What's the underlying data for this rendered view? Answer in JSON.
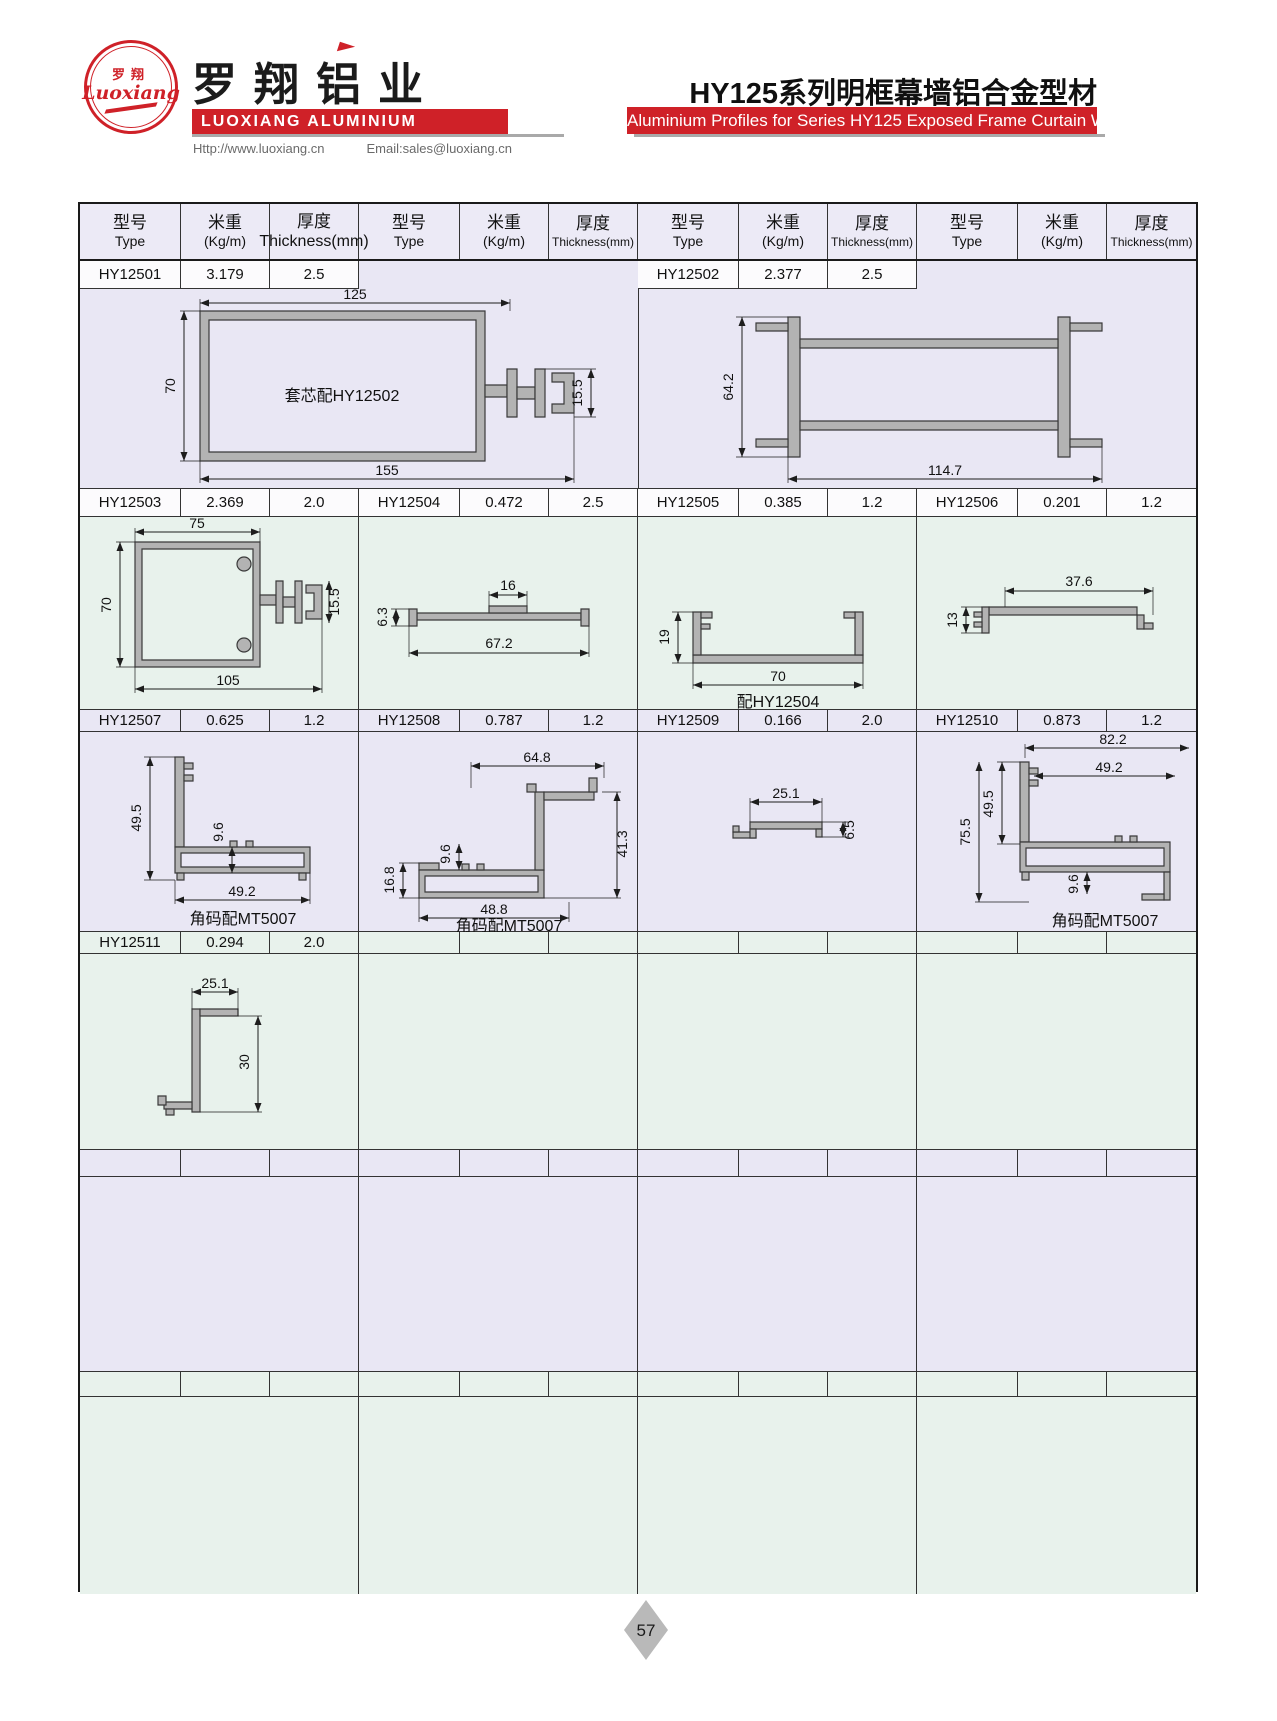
{
  "brand": {
    "logo_zh": "罗翔",
    "logo_script": "Luoxiang",
    "name_zh": "罗翔铝业",
    "name_en": "LUOXIANG ALUMINIUM",
    "website": "Http://www.luoxiang.cn",
    "email": "Email:sales@luoxiang.cn"
  },
  "title": {
    "zh": "HY125系列明框幕墙铝合金型材",
    "en": "Aluminium Profiles for Series HY125 Exposed Frame Curtain Wall"
  },
  "header": {
    "type_zh": "型号",
    "type_en": "Type",
    "weight_zh": "米重",
    "weight_en": "(Kg/m)",
    "thick_zh": "厚度",
    "thick_en": "Thickness(mm)"
  },
  "profiles": {
    "hy12501": {
      "type": "HY12501",
      "weight": "3.179",
      "thickness": "2.5",
      "note": "套芯配HY12502",
      "dim_top": "125",
      "dim_left": "70",
      "dim_bottom": "155",
      "dim_right": "15.5"
    },
    "hy12502": {
      "type": "HY12502",
      "weight": "2.377",
      "thickness": "2.5",
      "dim_left": "64.2",
      "dim_bottom": "114.7"
    },
    "hy12503": {
      "type": "HY12503",
      "weight": "2.369",
      "thickness": "2.0",
      "dim_top": "75",
      "dim_left": "70",
      "dim_right": "15.5",
      "dim_bottom": "105"
    },
    "hy12504": {
      "type": "HY12504",
      "weight": "0.472",
      "thickness": "2.5",
      "dim_left": "6.3",
      "dim_top": "16",
      "dim_bottom": "67.2"
    },
    "hy12505": {
      "type": "HY12505",
      "weight": "0.385",
      "thickness": "1.2",
      "note": "配HY12504",
      "dim_left": "19",
      "dim_bottom": "70"
    },
    "hy12506": {
      "type": "HY12506",
      "weight": "0.201",
      "thickness": "1.2",
      "dim_top": "37.6",
      "dim_left": "13"
    },
    "hy12507": {
      "type": "HY12507",
      "weight": "0.625",
      "thickness": "1.2",
      "note": "角码配MT5007",
      "dim_left": "49.5",
      "dim_mid": "9.6",
      "dim_bottom": "49.2"
    },
    "hy12508": {
      "type": "HY12508",
      "weight": "0.787",
      "thickness": "1.2",
      "note": "角码配MT5007",
      "dim_top": "64.8",
      "dim_mid": "9.6",
      "dim_left": "16.8",
      "dim_right": "41.3",
      "dim_bottom": "48.8"
    },
    "hy12509": {
      "type": "HY12509",
      "weight": "0.166",
      "thickness": "2.0",
      "dim_top": "25.1",
      "dim_right": "6.5"
    },
    "hy12510": {
      "type": "HY12510",
      "weight": "0.873",
      "thickness": "1.2",
      "note": "角码配MT5007",
      "dim_top": "82.2",
      "dim_top2": "49.2",
      "dim_left": "49.5",
      "dim_left2": "75.5",
      "dim_mid": "9.6"
    },
    "hy12511": {
      "type": "HY12511",
      "weight": "0.294",
      "thickness": "2.0",
      "dim_top": "25.1",
      "dim_right": "30"
    }
  },
  "footer": {
    "page": "57"
  }
}
